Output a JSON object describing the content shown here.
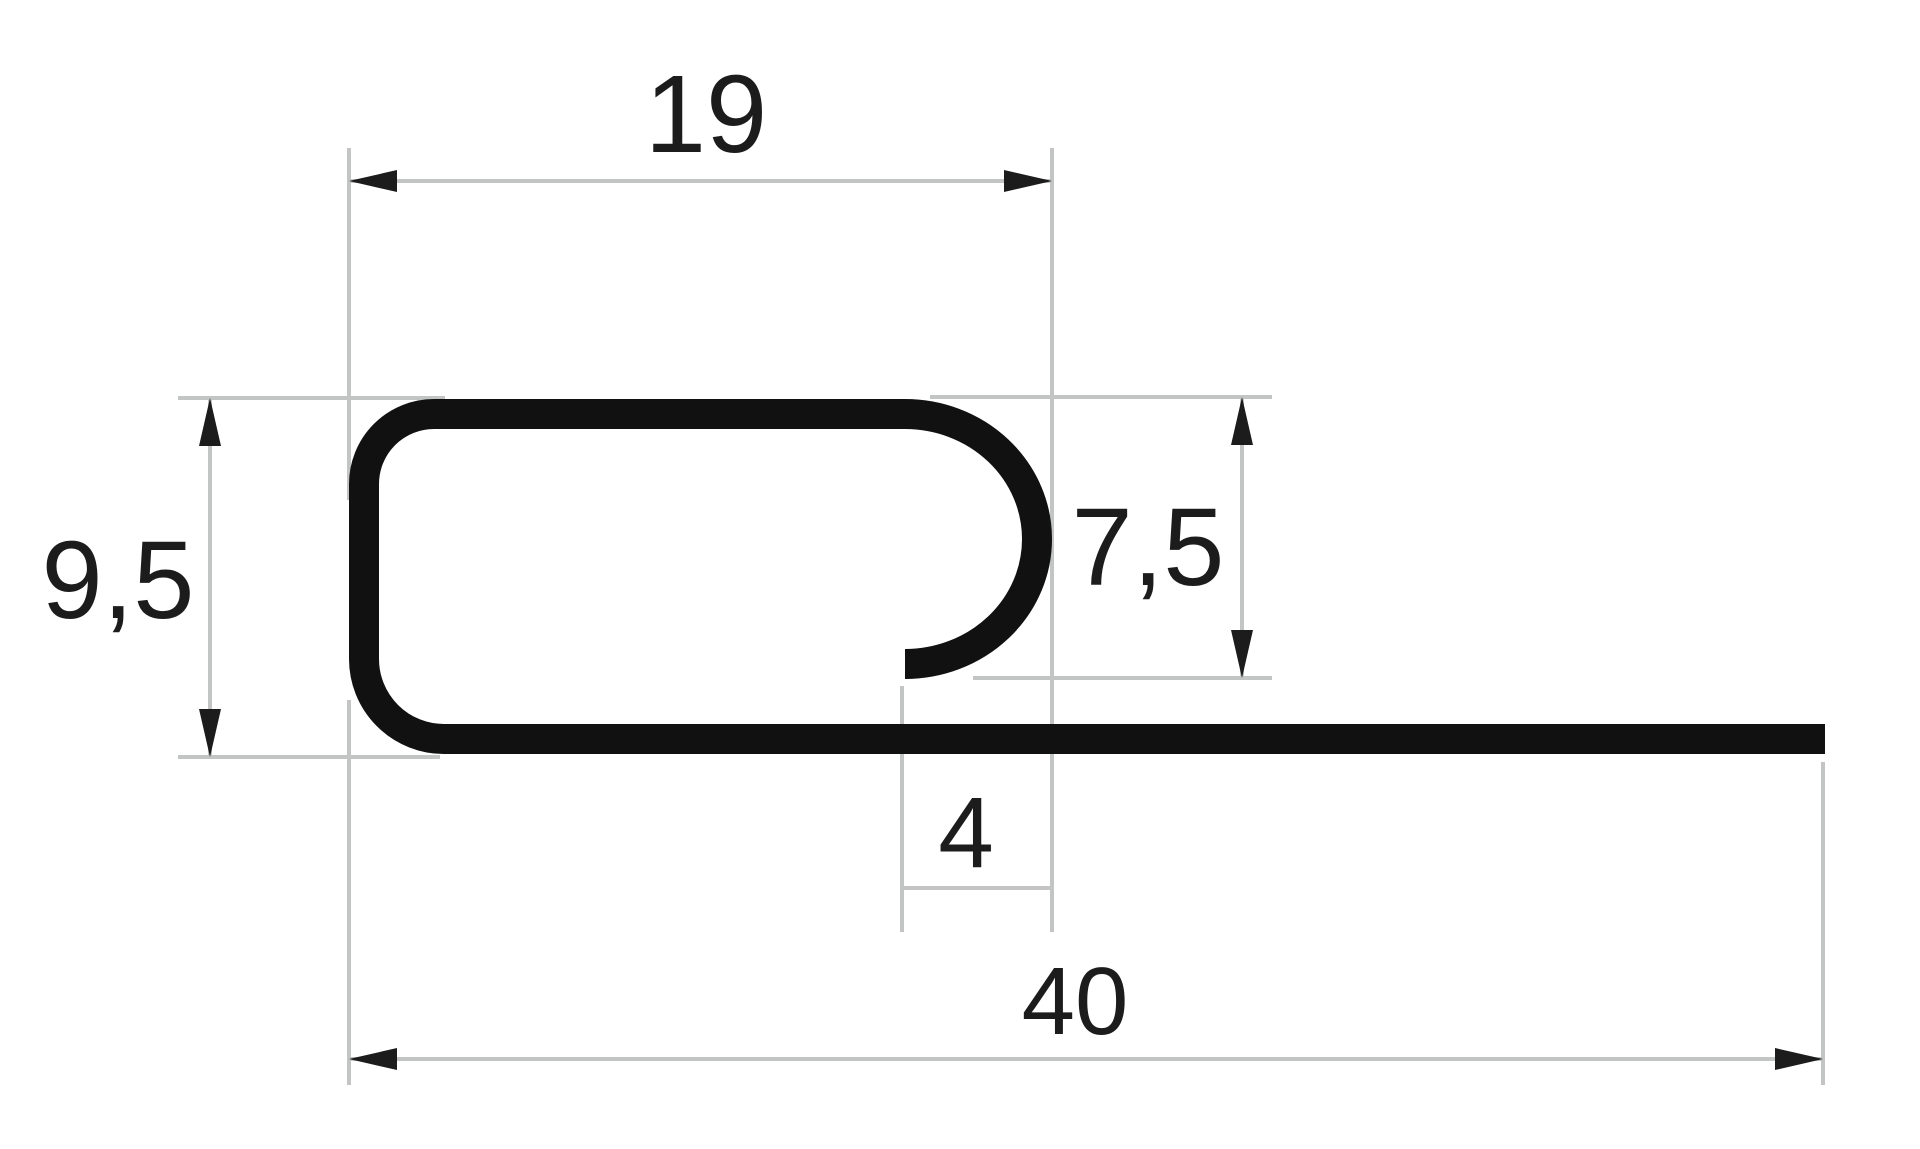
{
  "drawing": {
    "kind": "profile-cross-section",
    "dim_labels": {
      "width_top": "19",
      "height_left": "9,5",
      "height_right": "7,5",
      "opening": "4",
      "width_total": "40"
    }
  },
  "colors": {
    "background": "#ffffff",
    "profile": "#111111",
    "dim_line": "#c3c5c5",
    "ink": "#1c1c1c"
  }
}
